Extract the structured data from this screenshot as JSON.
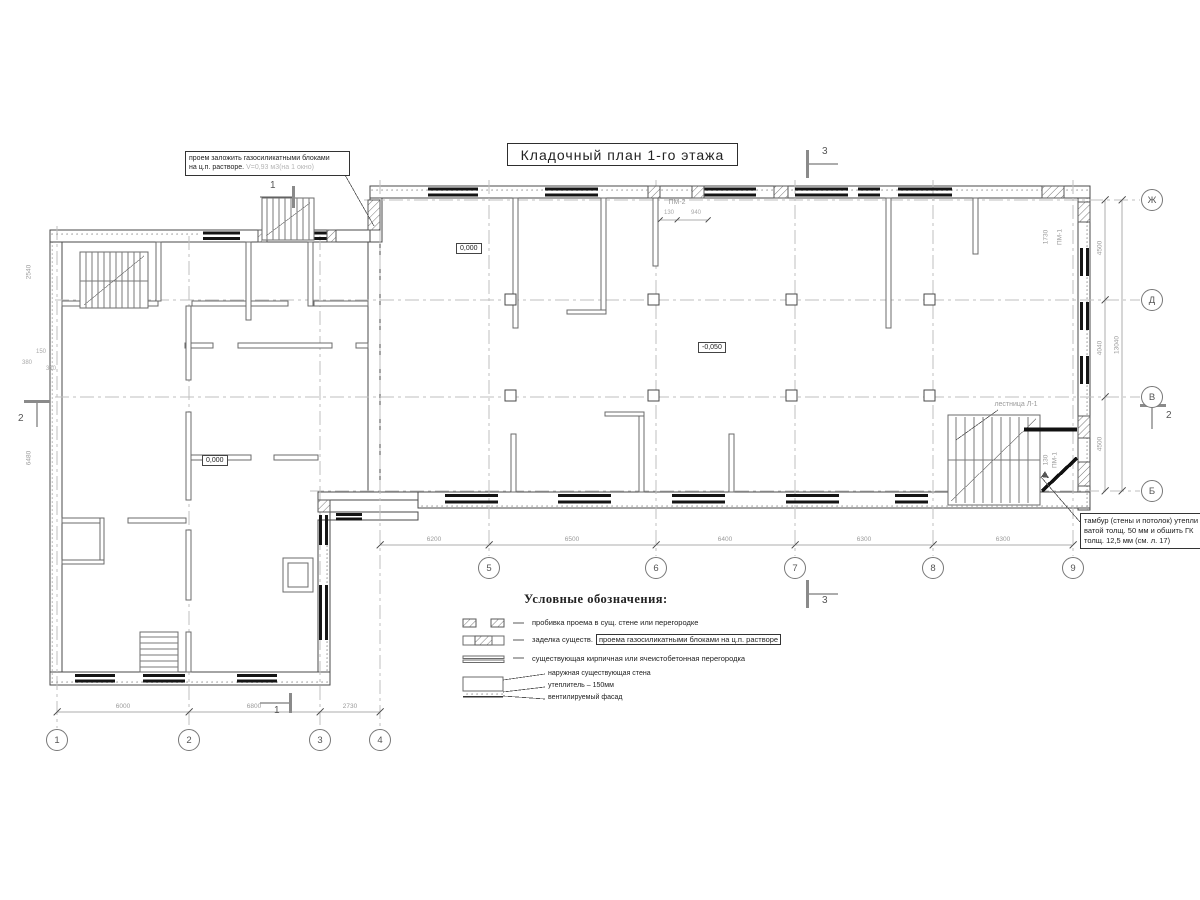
{
  "title": "Кладочный план 1-го этажа",
  "callouts": {
    "opening": {
      "line1": "проем заложить газосиликатными блоками",
      "line2": "на ц.п. растворе.",
      "note": "V=0,93 м3(на 1 окно)"
    },
    "tambour": {
      "line1": "тамбур (стены и потолок) утепли",
      "line2": "ватой толщ. 50 мм и обшить ГК",
      "line3": "толщ. 12,5 мм (см. л. 17)"
    },
    "stair_label": "лестница Л-1"
  },
  "elevations": {
    "entry": "0,000",
    "left_wing": "0,000",
    "hall": "-0,050"
  },
  "marks": {
    "pm2": "ПМ-2",
    "pm1": "ПМ-1",
    "pm1_stair": "ПМ-1"
  },
  "sections": {
    "s1": "1",
    "s2": "2",
    "s3": "3"
  },
  "grid": {
    "cols": [
      "1",
      "2",
      "3",
      "4",
      "5",
      "6",
      "7",
      "8",
      "9"
    ],
    "rows": [
      "Ж",
      "Д",
      "В",
      "Б"
    ]
  },
  "dims": {
    "b1": "6000",
    "b2": "6800",
    "b3": "2730",
    "r1": "6200",
    "r2": "6500",
    "r3": "6400",
    "r4": "6300",
    "r5": "6300",
    "v1": "4500",
    "v2": "4040",
    "v3": "4500",
    "vtotal": "13040",
    "d1730": "1730",
    "d130": "130",
    "d940": "940",
    "d130b": "130",
    "d150": "150",
    "d380": "380",
    "d310": "310",
    "d2540": "2540",
    "d6480": "6480"
  },
  "legend": {
    "title": "Условные обозначения:",
    "item1": "пробивка проема  в сущ. стене  или перегородке",
    "item2_prefix": "заделка существ.",
    "item2_boxed": "проема газосиликатными блоками на ц.п. растворе",
    "item3": "существующая кирпичная или ячеистобетонная перегородка",
    "wall1": "наружная существующая стена",
    "wall2": "утеплитель – 150мм",
    "wall3": "вентилируемый фасад"
  }
}
